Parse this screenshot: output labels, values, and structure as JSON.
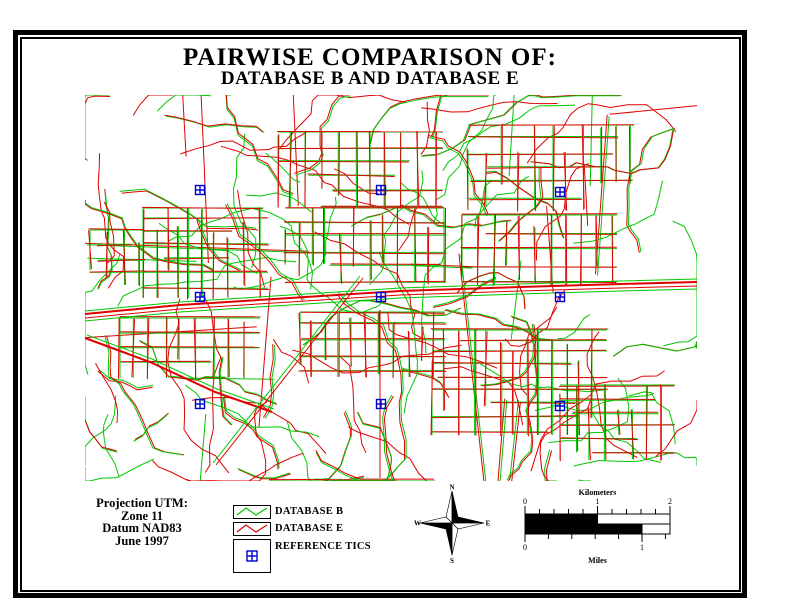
{
  "header": {
    "title": "PAIRWISE COMPARISON OF:",
    "subtitle": "DATABASE B AND DATABASE E"
  },
  "info_block": {
    "lines": [
      "Projection UTM:",
      "Zone 11",
      "Datum NAD83",
      "June 1997"
    ]
  },
  "legend": {
    "items": [
      {
        "label": "DATABASE B",
        "symbol": "green-zigzag-line",
        "color": "#00c800"
      },
      {
        "label": "DATABASE E",
        "symbol": "red-zigzag-line",
        "color": "#e00000"
      },
      {
        "label": "REFERENCE TICS",
        "symbol": "blue-cross-in-square",
        "color": "#0000d0"
      }
    ]
  },
  "compass": {
    "north": "N",
    "east": "E",
    "south": "S",
    "west": "W"
  },
  "scalebar": {
    "top_label": "Kilometers",
    "bottom_label": "Miles",
    "km_ticks": [
      "0",
      "1",
      "2"
    ],
    "mi_ticks": [
      "0",
      "1"
    ]
  },
  "map": {
    "colors": {
      "db_b": "#00c800",
      "db_e": "#e00000",
      "tics": "#0000d0"
    },
    "bounds": [
      85,
      95,
      697,
      481
    ],
    "seed": 1997,
    "gen": {
      "straights": 20,
      "wiggly": 108
    },
    "clusters": [
      [
        143,
        208,
        125,
        90,
        13
      ],
      [
        278,
        132,
        165,
        75,
        15
      ],
      [
        285,
        208,
        160,
        75,
        14
      ],
      [
        468,
        125,
        165,
        85,
        15
      ],
      [
        462,
        215,
        155,
        70,
        15
      ],
      [
        300,
        312,
        145,
        65,
        14
      ],
      [
        432,
        330,
        175,
        105,
        13
      ],
      [
        120,
        318,
        140,
        60,
        16
      ],
      [
        560,
        385,
        115,
        75,
        14
      ],
      [
        90,
        230,
        55,
        55,
        14
      ]
    ],
    "highways": [
      {
        "name": "main-highway",
        "pts": [
          [
            85,
            314
          ],
          [
            180,
            305
          ],
          [
            290,
            298
          ],
          [
            400,
            291
          ],
          [
            520,
            287
          ],
          [
            620,
            284
          ],
          [
            697,
            282
          ]
        ],
        "strokes": [
          {
            "c": "db_e",
            "dx": 0,
            "dy": 0,
            "w": 2
          },
          {
            "c": "db_e",
            "dx": 0,
            "dy": 4,
            "w": 1
          },
          {
            "c": "db_b",
            "dx": 0,
            "dy": -3,
            "w": 1
          },
          {
            "c": "db_b",
            "dx": 0,
            "dy": 7,
            "w": 1
          }
        ]
      },
      {
        "name": "left-diagonal",
        "pts": [
          [
            85,
            338
          ],
          [
            150,
            362
          ],
          [
            215,
            392
          ],
          [
            272,
            412
          ]
        ],
        "strokes": [
          {
            "c": "db_e",
            "dx": 0,
            "dy": 0,
            "w": 2
          },
          {
            "c": "db_b",
            "dx": 2,
            "dy": -3,
            "w": 1
          }
        ]
      },
      {
        "name": "rail-diagonal",
        "pts": [
          [
            213,
            463
          ],
          [
            360,
            276
          ]
        ],
        "strokes": [
          {
            "c": "db_b",
            "dx": 0,
            "dy": 0,
            "w": 1
          },
          {
            "c": "db_e",
            "dx": 3,
            "dy": 2,
            "w": 1
          }
        ]
      },
      {
        "name": "south-vertical",
        "pts": [
          [
            380,
            310
          ],
          [
            380,
            478
          ]
        ],
        "strokes": [
          {
            "c": "db_e",
            "dx": 0,
            "dy": 0,
            "w": 1
          }
        ]
      }
    ],
    "tics": [
      [
        200,
        190
      ],
      [
        381,
        190
      ],
      [
        560,
        192
      ],
      [
        200,
        297
      ],
      [
        381,
        297
      ],
      [
        560,
        297
      ],
      [
        200,
        404
      ],
      [
        381,
        404
      ],
      [
        560,
        406
      ]
    ]
  }
}
